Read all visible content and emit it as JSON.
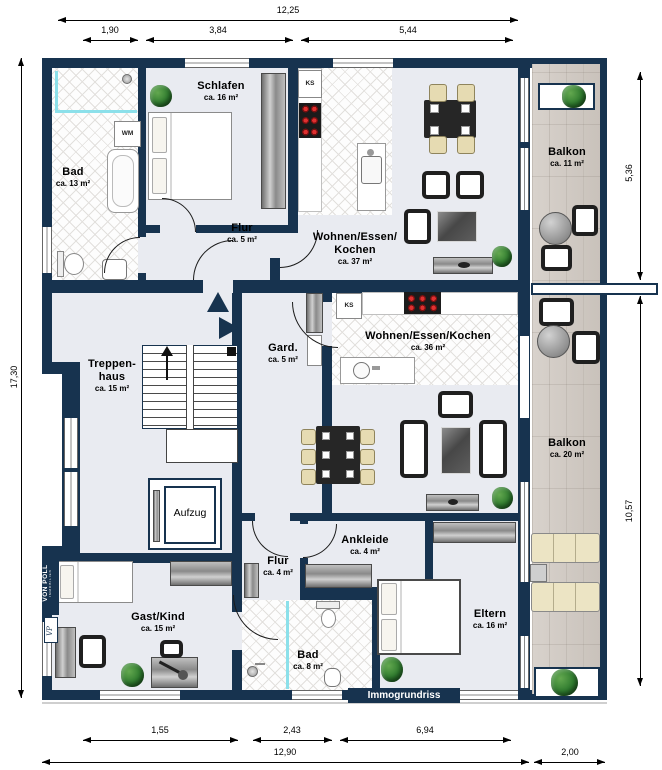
{
  "watermark": "Immogrundriss",
  "brand": {
    "name_top": "VON POLL",
    "name_bottom": "IMMOBILIEN",
    "monogram": "VP"
  },
  "dimensions": {
    "top_total": "12,25",
    "top_segments": [
      "1,90",
      "3,84",
      "5,44"
    ],
    "left_total": "17,30",
    "right_upper": "5,36",
    "right_lower": "10,57",
    "bottom_segments": [
      "1,55",
      "2,43",
      "6,94"
    ],
    "bottom_total": "12,90",
    "bottom_balcony": "2,00"
  },
  "rooms": {
    "bad_og": {
      "name": "Bad",
      "area": "ca. 13 m²"
    },
    "schlafen": {
      "name": "Schlafen",
      "area": "ca. 16 m²"
    },
    "flur_og": {
      "name": "Flur",
      "area": "ca. 5 m²"
    },
    "wohnen_37": {
      "name_line1": "Wohnen/Essen/",
      "name_line2": "Kochen",
      "area": "ca. 37 m²"
    },
    "balkon_11": {
      "name": "Balkon",
      "area": "ca. 11 m²"
    },
    "treppenhaus": {
      "name_line1": "Treppen-",
      "name_line2": "haus",
      "area": "ca. 15 m²"
    },
    "gard": {
      "name": "Gard.",
      "area": "ca. 5 m²"
    },
    "wohnen_36": {
      "name": "Wohnen/Essen/Kochen",
      "area": "ca. 36 m²"
    },
    "balkon_20": {
      "name": "Balkon",
      "area": "ca. 20 m²"
    },
    "aufzug": {
      "name": "Aufzug"
    },
    "flur_eg": {
      "name": "Flur",
      "area": "ca. 4 m²"
    },
    "ankleide": {
      "name": "Ankleide",
      "area": "ca. 4 m²"
    },
    "gast_kind": {
      "name": "Gast/Kind",
      "area": "ca. 15 m²"
    },
    "bad_8": {
      "name": "Bad",
      "area": "ca. 8 m²"
    },
    "eltern": {
      "name": "Eltern",
      "area": "ca. 16 m²"
    }
  },
  "appliances": {
    "washing_machine": "WM",
    "fridge_top": "KS",
    "fridge_bottom": "KS"
  },
  "colors": {
    "wall": "#17334f",
    "floor": "#e9ebf1",
    "tile_line": "#e2e0dd",
    "balcony_wood": "#d1cbc5",
    "shower_glass": "#8ce0ea",
    "burner_red": "#e03030",
    "plant_green": "#2e7a2e"
  }
}
